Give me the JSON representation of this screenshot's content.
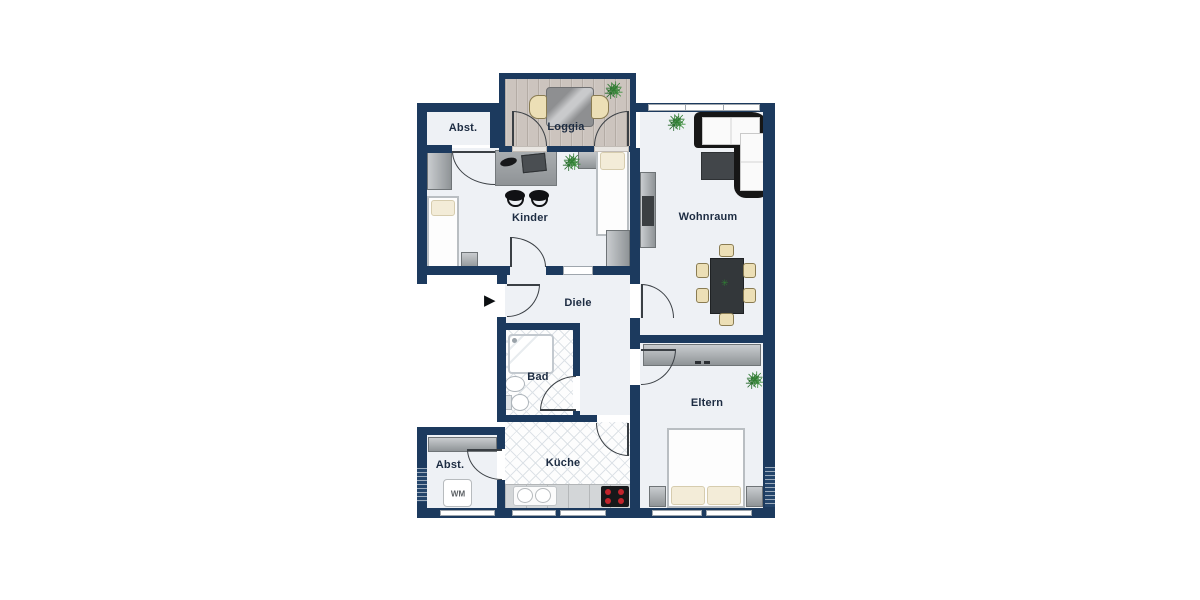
{
  "plan": {
    "type": "apartment-floorplan",
    "rooms": {
      "abst_top": {
        "label": "Abst."
      },
      "loggia": {
        "label": "Loggia"
      },
      "kinder": {
        "label": "Kinder"
      },
      "wohnraum": {
        "label": "Wohnraum"
      },
      "diele": {
        "label": "Diele"
      },
      "bad": {
        "label": "Bad"
      },
      "kueche": {
        "label": "Küche"
      },
      "eltern": {
        "label": "Eltern"
      },
      "abst_bottom": {
        "label": "Abst."
      }
    },
    "appliances": {
      "washing_machine": "WM"
    }
  },
  "icons": {
    "entry_arrow": "▶",
    "plant": "✳"
  },
  "colors": {
    "wall_navy": "#1c3a5e",
    "floor_light": "#eef1f5",
    "loggia_wood": "#ccc4be",
    "tile_line": "#dde2e7",
    "furniture_gray": "#9aa0a4",
    "chair_beige": "#ecdfb6",
    "dining_table_dark": "#33373a",
    "sofa_black": "#161616",
    "plant_green": "#2f7d33",
    "burner_red": "#c3242c",
    "label_text": "#1d2c42"
  }
}
